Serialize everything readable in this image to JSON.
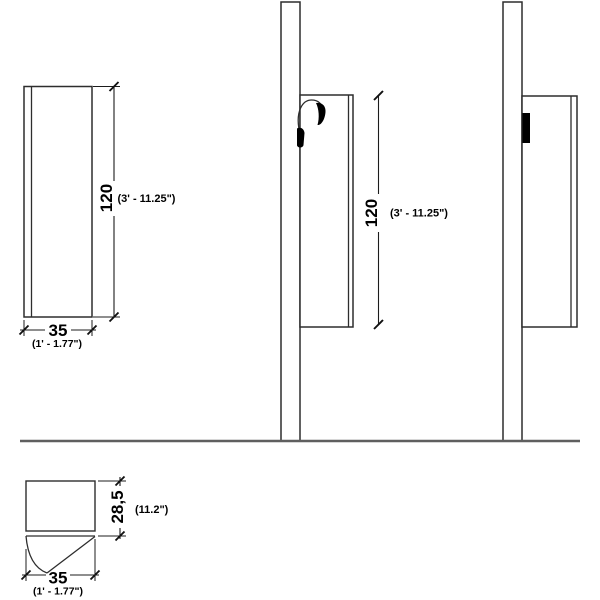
{
  "drawing": {
    "front_view": {
      "height": "120",
      "height_alt": "(3' - 11.25\")",
      "width": "35",
      "width_alt": "(1' - 1.77\")"
    },
    "side_view": {
      "height": "120",
      "height_alt": "(3' - 11.25\")"
    },
    "plan_view": {
      "depth": "28,5",
      "depth_alt": "(11.2\")",
      "width": "35",
      "width_alt": "(1' - 1.77\")"
    },
    "colors": {
      "line": "#2d2d2d",
      "dimension_line": "#1c1c1c",
      "ground_line": "#5f5f5f",
      "text": "#000000",
      "hardware": "#000000",
      "background": "#ffffff"
    }
  }
}
